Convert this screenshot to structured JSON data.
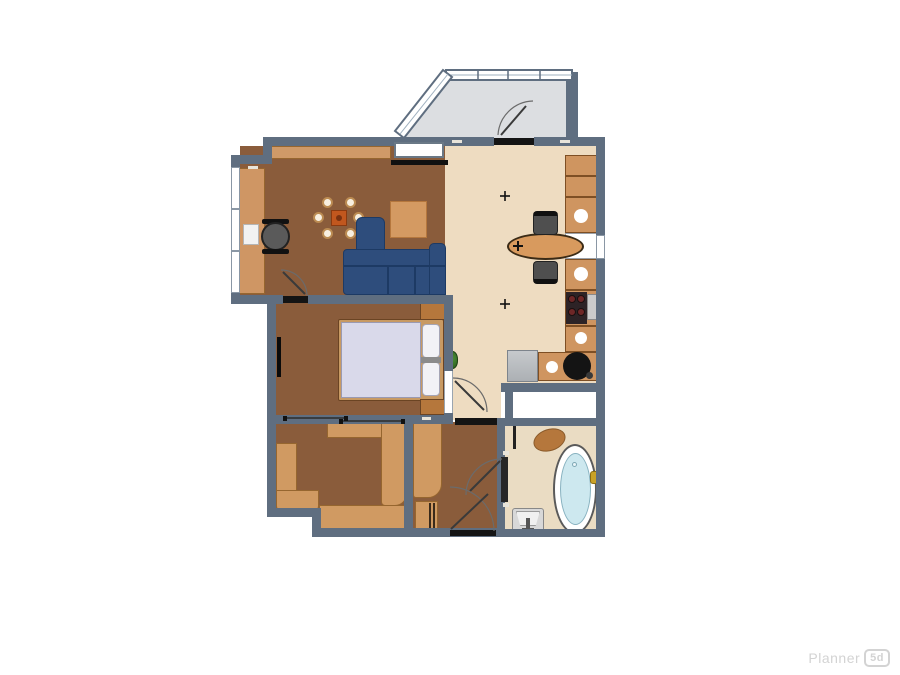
{
  "watermark": {
    "brand": "Planner",
    "badge": "5d"
  },
  "colors": {
    "wall": "#5f6e80",
    "wood_floor": "#8a5c3b",
    "tile_floor": "#eedcc1",
    "balcony_floor": "#dcdee1",
    "furniture_tan": "#d09a62",
    "sofa_blue": "#2e4d7c",
    "bed_mattress": "#d9d9ea",
    "bath_water": "#cde8ef",
    "faucet_gold": "#c9a227",
    "plant_green": "#3e7d2c",
    "threshold_black": "#141414"
  },
  "floorplan": {
    "rooms": [
      {
        "name": "balcony",
        "floor_color": "#dcdee1",
        "furniture": [
          "glazed-windows",
          "balcony-door"
        ]
      },
      {
        "name": "living-room",
        "floor_color": "#8a5c3b",
        "furniture": [
          "wall-cabinet",
          "window-unit",
          "tv-bar",
          "long-desk",
          "laptop",
          "office-chair",
          "dining-table",
          "dining-chairs-x6",
          "corner-sofa",
          "square-rug",
          "interior-door"
        ]
      },
      {
        "name": "kitchen",
        "floor_color": "#eedcc1",
        "furniture": [
          "counter-run",
          "sink-x3",
          "dishwasher",
          "cooktop",
          "washing-machine",
          "round-basin",
          "oval-island-table",
          "stools-x2",
          "ceiling-lamp-x2",
          "plant"
        ]
      },
      {
        "name": "bedroom",
        "floor_color": "#8a5c3b",
        "furniture": [
          "double-bed",
          "pillows-x2",
          "nightstand-x2",
          "wall-tv",
          "sliding-door"
        ]
      },
      {
        "name": "second-room",
        "floor_color": "#8a5c3b",
        "furniture": [
          "corner-seating",
          "top-cabinet",
          "tall-wardrobe"
        ]
      },
      {
        "name": "hallway",
        "floor_color": "#8a5c3b",
        "furniture": [
          "tall-wardrobe",
          "shoe-cabinet",
          "entrance-door",
          "bathroom-door"
        ]
      },
      {
        "name": "storage",
        "floor_color": "#ffffff",
        "furniture": []
      },
      {
        "name": "bathroom",
        "floor_color": "#eadcc3",
        "furniture": [
          "oval-bathtub",
          "gold-faucet",
          "wash-basin",
          "oval-rug",
          "towel-rail"
        ]
      }
    ]
  }
}
